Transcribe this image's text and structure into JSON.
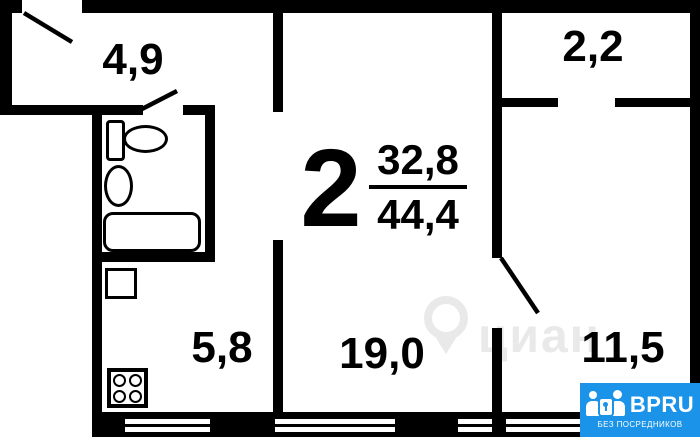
{
  "page": {
    "background": "#ffffff",
    "ink": "#000000"
  },
  "floor_plan": {
    "summary": {
      "rooms_count": "2",
      "numerator": "32,8",
      "denominator": "44,4"
    },
    "areas": {
      "hallway": "4,9",
      "closet": "2,2",
      "kitchen": "5,8",
      "living_room": "19,0",
      "bedroom": "11,5"
    }
  },
  "watermark": {
    "brand": "циан",
    "color": "#e9e9e9"
  },
  "logo": {
    "brand": "BPRU",
    "tagline": "БЕЗ ПОСРЕДНИКОВ",
    "background": "#1a93e8"
  }
}
